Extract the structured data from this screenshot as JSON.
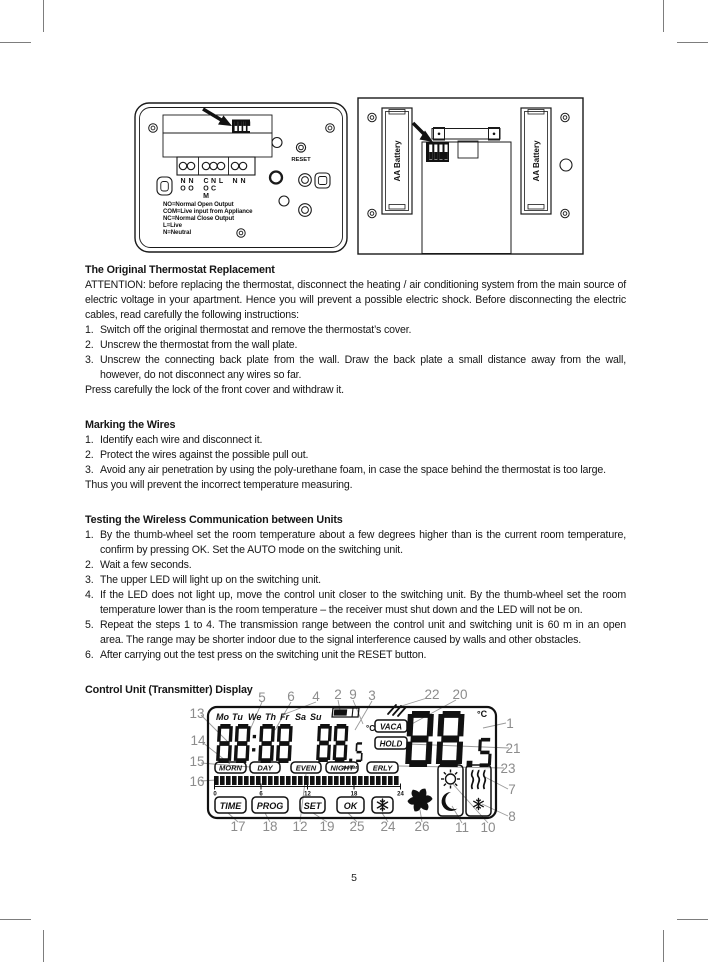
{
  "page_number": "5",
  "wiring_diagram": {
    "reset_label": "RESET",
    "terminals": [
      [
        "N",
        "O"
      ],
      [
        "N",
        "O"
      ],
      [
        "C",
        "O",
        "M"
      ],
      [
        "N",
        "C"
      ],
      [
        "L"
      ],
      [
        "N"
      ],
      [
        "N"
      ]
    ],
    "legend": [
      "NO=Normal Open Output",
      "COM=Live input from Appliance",
      "NC=Normal Close Output",
      "L=Live",
      "N=Neutral"
    ],
    "icons": [
      "dip-switch-icon",
      "arrow-icon",
      "screw-icon",
      "reset-button-icon"
    ]
  },
  "battery_diagram": {
    "left_label": "AA Battery",
    "right_label": "AA Battery",
    "icons": [
      "dip-switch-icon",
      "arrow-icon",
      "screw-icon"
    ]
  },
  "sections": [
    {
      "heading": "The Original Thermostat Replacement",
      "intro": "ATTENTION: before replacing the thermostat, disconnect the heating / air conditioning system from the main source of electric voltage in your apartment. Hence you will prevent a possible electric shock. Before disconnecting the electric cables, read carefully the following instructions:",
      "items": [
        "Switch off the original thermostat and remove the thermostat’s cover.",
        "Unscrew the thermostat from the wall plate.",
        "Unscrew the connecting back plate from the wall. Draw the back plate a small distance away from the wall, however, do not disconnect any wires so far."
      ],
      "outro": "Press carefully the lock of the front cover and withdraw it."
    },
    {
      "heading": "Marking the Wires",
      "items": [
        "Identify each wire and disconnect it.",
        "Protect the wires against the possible pull out.",
        "Avoid any air penetration by using the poly-urethane foam, in case the space behind the thermostat is too large."
      ],
      "outro": "Thus you will prevent the incorrect temperature measuring."
    },
    {
      "heading": "Testing the Wireless Communication between Units",
      "items": [
        "By the thumb-wheel set the room temperature about a few degrees higher than is the current room temperature, confirm by pressing OK. Set the AUTO mode on the switching unit.",
        "Wait a few seconds.",
        "The upper LED will light up on the switching unit.",
        "If the LED does not light up, move the control unit closer to the switching unit. By the thumb-wheel set the room temperature lower than is the room temperature – the receiver must shut down and the LED will not be on.",
        "Repeat the steps 1 to 4. The transmission range between the control unit and switching unit is 60 m in an open area. The range may be shorter indoor due to the signal interference caused by walls and other obstacles.",
        "After carrying out the test press on the switching unit the RESET button."
      ]
    },
    {
      "heading": "Control Unit (Transmitter) Display"
    }
  ],
  "lcd": {
    "days": [
      "Mo",
      "Tu",
      "We",
      "Th",
      "Fr",
      "Sa",
      "Su"
    ],
    "time": "88:88",
    "small_temp": "88.5",
    "small_temp_unit": "°C",
    "room_label": "ROOM",
    "vaca_label": "VACA",
    "hold_label": "HOLD",
    "big_temp": "88.5",
    "big_temp_unit": "°C",
    "periods": [
      "MORN",
      "DAY",
      "EVEN",
      "NIGHT",
      "ERLY"
    ],
    "timeline_ticks": [
      "0",
      "6",
      "12",
      "18",
      "24"
    ],
    "buttons": [
      "TIME",
      "PROG",
      "SET",
      "OK"
    ],
    "icons": [
      "battery-icon",
      "transmit-icon",
      "snowflake-button-icon",
      "fan-icon",
      "sun-icon",
      "moon-icon",
      "heat-icon",
      "frost-icon"
    ],
    "callouts": [
      "5",
      "6",
      "4",
      "2",
      "9",
      "3",
      "22",
      "20",
      "13",
      "14",
      "15",
      "16",
      "1",
      "21",
      "23",
      "7",
      "8",
      "17",
      "18",
      "12",
      "19",
      "25",
      "24",
      "26",
      "11",
      "10"
    ]
  }
}
